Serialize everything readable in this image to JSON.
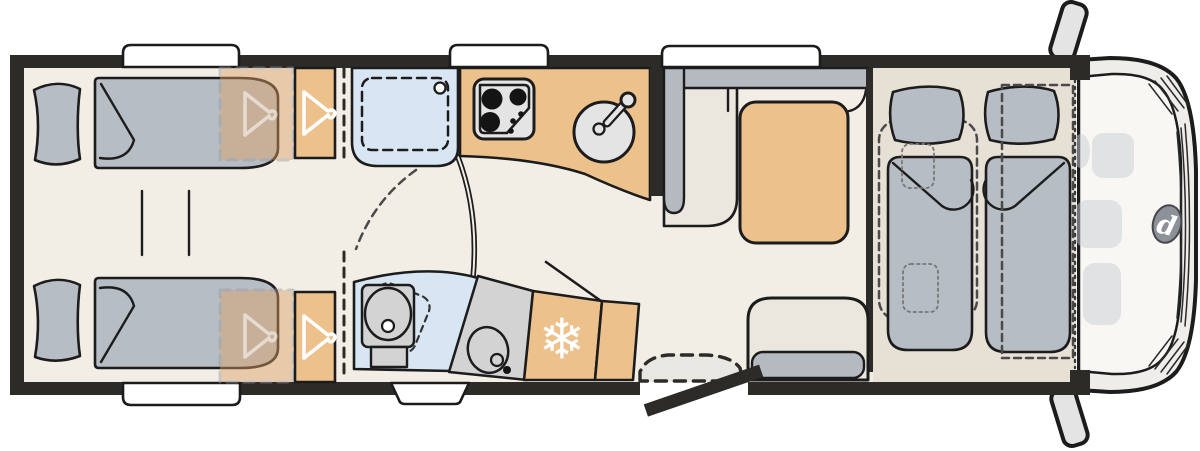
{
  "title": "Motorhome floor plan (top view)",
  "diagram_type": "vehicle-floor-plan",
  "glyphs": {
    "snowflake": "❄",
    "brand_logo_letter": "d"
  },
  "colors": {
    "wall": "#2d2b28",
    "line": "#1c1c1c",
    "floor": "#f2eee6",
    "bench": "#ece7de",
    "platform": "#e7e0d5",
    "mattress": "#b7bdc5",
    "grey": "#b5bac1",
    "tan": "#edc18c",
    "tan_deep": "#dd9f63",
    "blue": "#d8e6f3",
    "counter": "#d3d3d3",
    "appliance": "#e4e4e4",
    "white": "#ffffff",
    "step": "#e9e7e2",
    "cab_body": "#efedea",
    "cab_glass": "#f8f7f3",
    "cab_seat": "#c9ced4",
    "mirror": "#e4e4e4",
    "logo_bg": "#8d9298",
    "dash": "#4a4a4a"
  },
  "inventory": {
    "rear_bedroom": [
      "single-bed-top",
      "single-bed-bottom",
      "pillows",
      "center-step-unit",
      "wardrobe-top-with-hanger",
      "wardrobe-bottom-with-hanger"
    ],
    "washroom": [
      "shower-tray",
      "swivel-toilet",
      "washbasin-counter",
      "oval-basin"
    ],
    "kitchen": [
      "three-burner-hob",
      "round-sink-with-faucet",
      "fridge-with-snowflake",
      "tall-cabinet"
    ],
    "dinette": [
      "l-shaped-bench",
      "table",
      "side-bench-with-cushion"
    ],
    "entry": [
      "open-door",
      "entry-step"
    ],
    "front": [
      "drop-down-bed-left",
      "drop-down-bed-right",
      "cab-seats",
      "windscreen",
      "grille",
      "brand-logo",
      "side-mirrors"
    ],
    "windows": {
      "top": 3,
      "bottom": 2
    },
    "hob_burners": 3
  }
}
